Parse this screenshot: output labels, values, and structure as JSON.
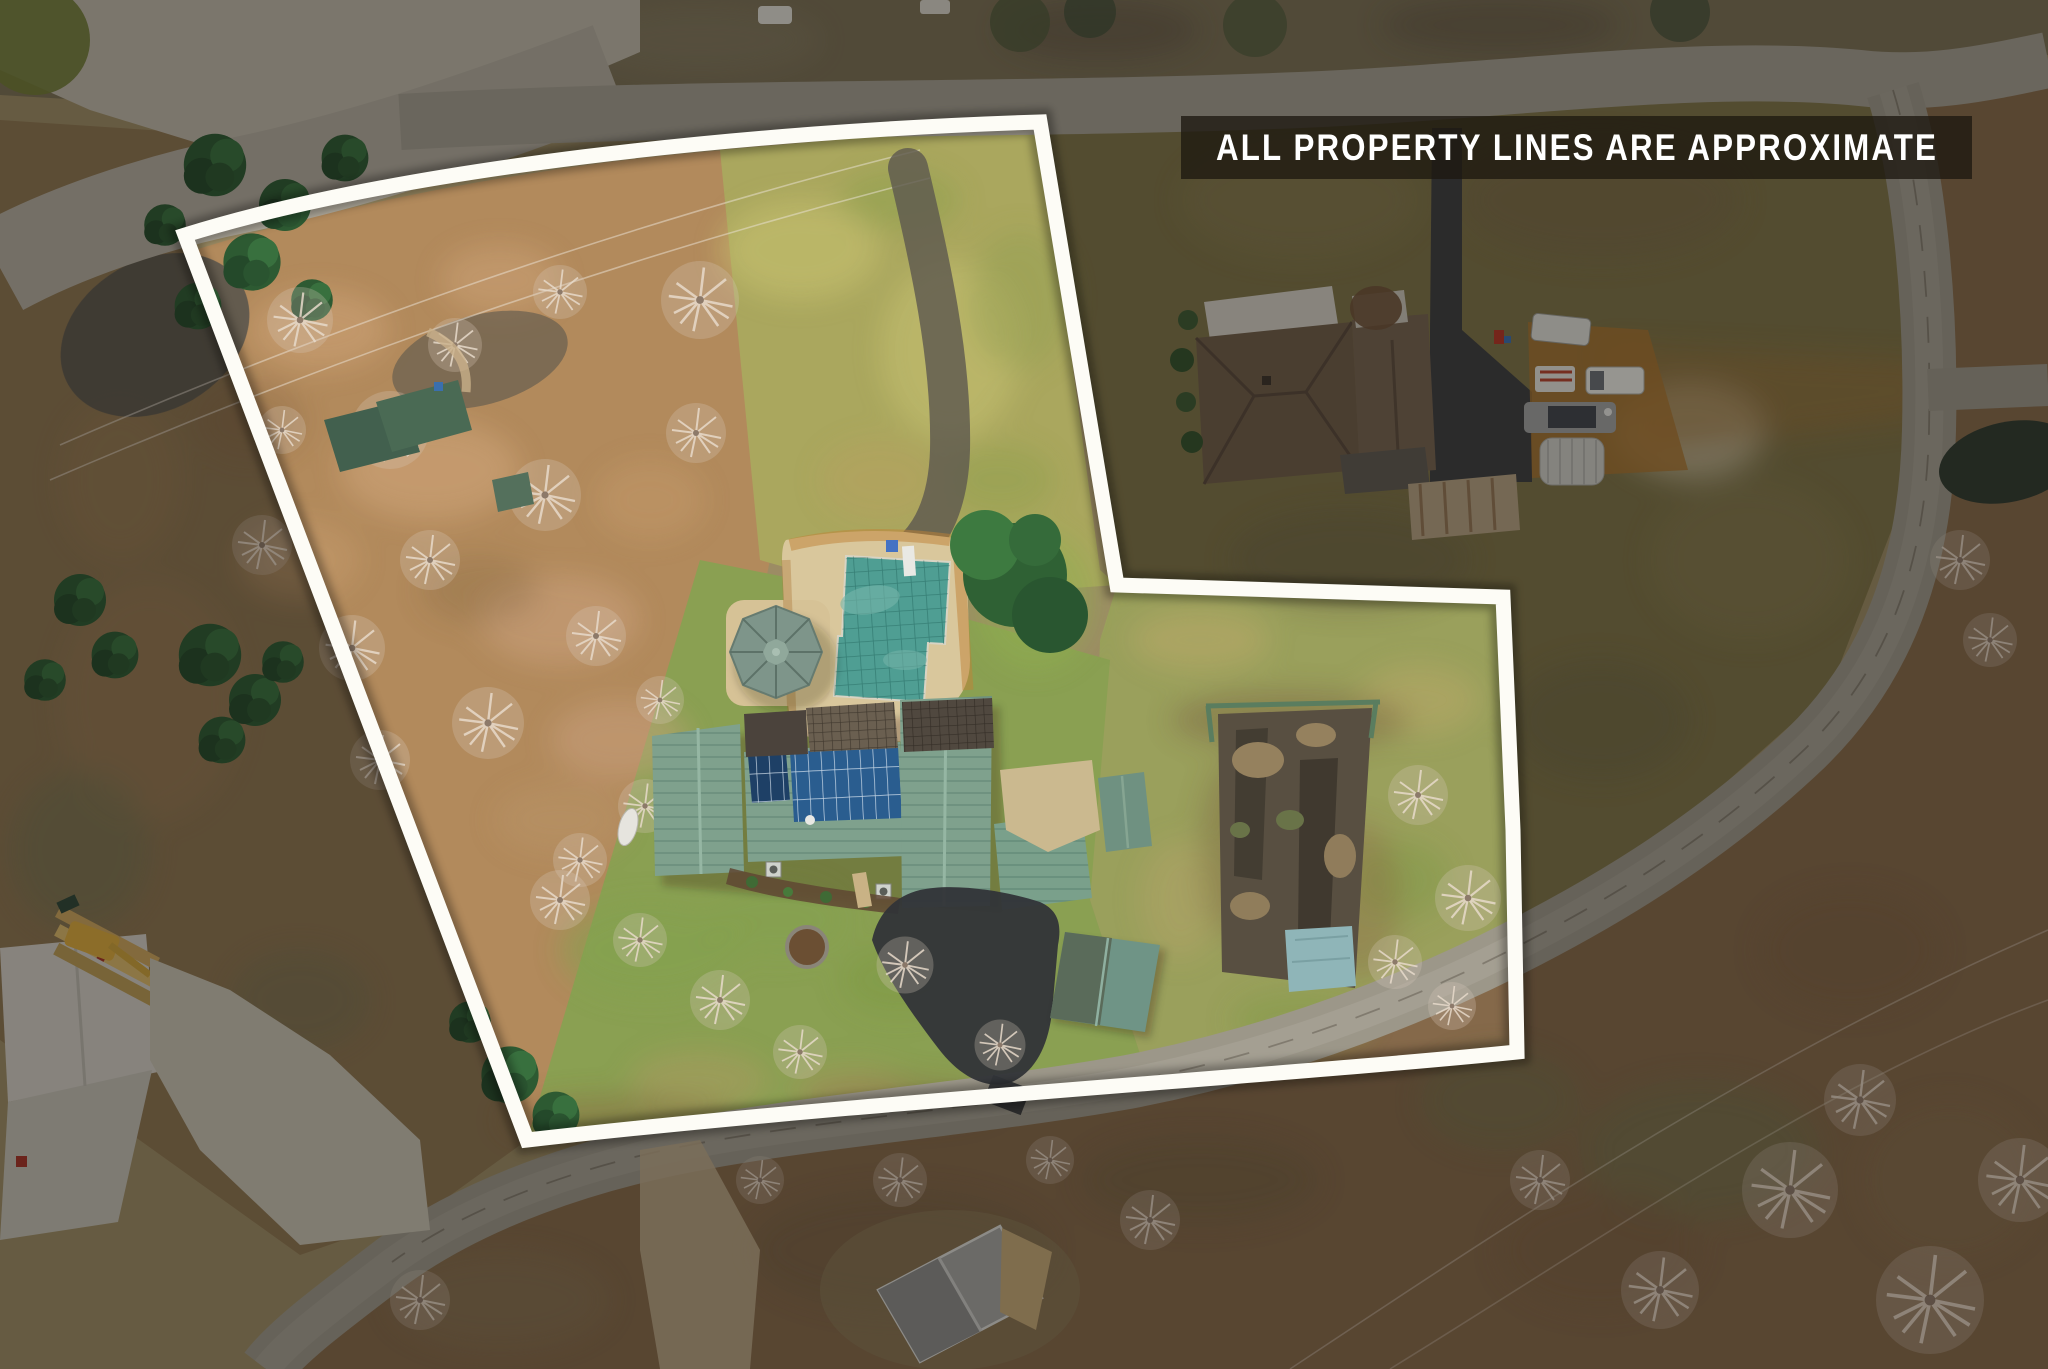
{
  "image": {
    "type": "aerial-drone-real-estate-photo",
    "description": "overhead drone view of a residential lot outlined in white"
  },
  "banner": {
    "text": "ALL PROPERTY LINES ARE APPROXIMATE"
  },
  "colors": {
    "property_line": "#fdfcf6",
    "banner_background": "rgba(30,24,17,0.78)",
    "banner_text": "#ffffff",
    "pool_cover_teal": "#4f9e93",
    "metal_roof_green": "#7fa18d",
    "solar_panel_blue": "#2a5d8f",
    "asphalt_road": "#9c9789",
    "driveway_asphalt": "#313438",
    "leaf_litter": "#b28a5c",
    "meadow_green": "#aaa75e",
    "outside_dim": "rgba(17,14,10,0.38)"
  },
  "features": [
    "property-boundary",
    "main-house-green-metal-roof",
    "rooftop-solar-array",
    "swimming-pool-with-green-cover",
    "gazebo",
    "pool-deck",
    "old-tennis-court",
    "detached-garage",
    "well-house-shed",
    "storage-shed-in-woods",
    "asphalt-driveway",
    "neighbor-house",
    "neighbor-driveway-with-rv-trucks-and-carport",
    "barn-with-white-roof",
    "lumber-stacks",
    "excavator",
    "gray-roof-house",
    "loop-road",
    "pond",
    "power-lines",
    "bare-winter-trees",
    "evergreen-trees"
  ]
}
